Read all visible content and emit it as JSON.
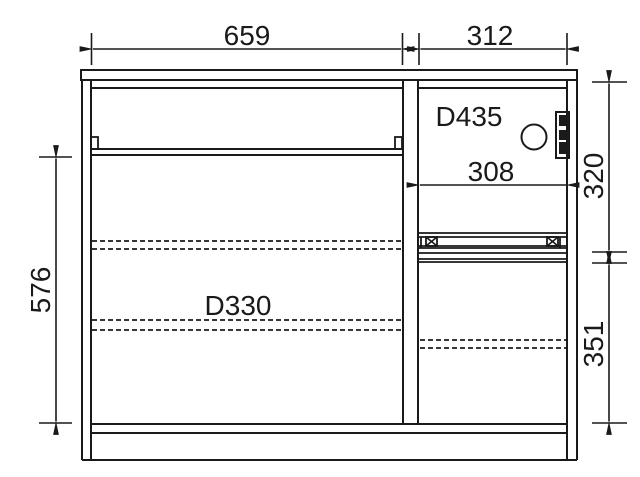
{
  "drawing": {
    "background": "#ffffff",
    "line_color": "#1a1a1a",
    "labels": {
      "dim_width_left": "659",
      "dim_width_right": "312",
      "depth_upper_right": "D435",
      "dim_inner_width": "308",
      "dim_height_upper_right": "320",
      "dim_height_left": "576",
      "depth_lower_left": "D330",
      "dim_height_lower_right": "351"
    }
  }
}
